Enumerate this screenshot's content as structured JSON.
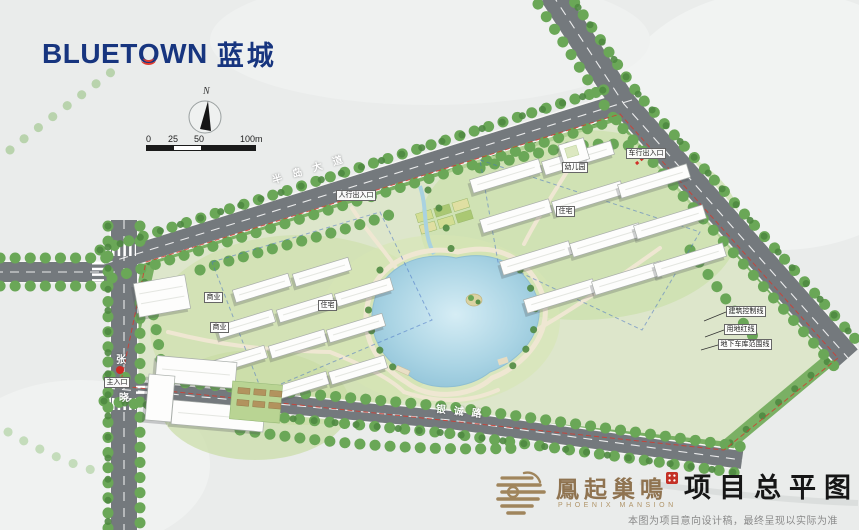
{
  "brand": {
    "logo_part1": "BLUET",
    "logo_o": "O",
    "logo_part2": "WN",
    "logo_cjk": "蓝城"
  },
  "compass": {
    "north": "N"
  },
  "scalebar": {
    "t0": "0",
    "t1": "25",
    "t2": "50",
    "t3": "100m"
  },
  "roads": {
    "top": "半岛大道",
    "bottom": "银诚路",
    "left_top_char": "张",
    "left_bottom_char": "晓"
  },
  "plan_labels": {
    "commercial_a": "商业",
    "commercial_b": "商业",
    "residential_a": "住宅",
    "residential_b": "住宅",
    "kindergarten": "幼儿园",
    "entrance_north": "人行出入口",
    "entrance_northeast": "车行出入口",
    "entrance_west": "主入口"
  },
  "callouts": {
    "c1": "建筑控制线",
    "c2": "用地红线",
    "c3": "地下车库范围线"
  },
  "footer": {
    "project_name": "鳳起巢鳴",
    "project_name_en": "PHOENIX MANSION",
    "drawing_title": "项目总平图",
    "disclaimer": "本图为项目意向设计稿，最终呈现以实际为准"
  },
  "colors": {
    "brand_blue": "#17357f",
    "brand_red": "#e23a2e",
    "road_grey": "#74797d",
    "tree_green": "#6aa757",
    "lake_blue": "#9ccbdd",
    "footer_brown": "#8f7350"
  }
}
